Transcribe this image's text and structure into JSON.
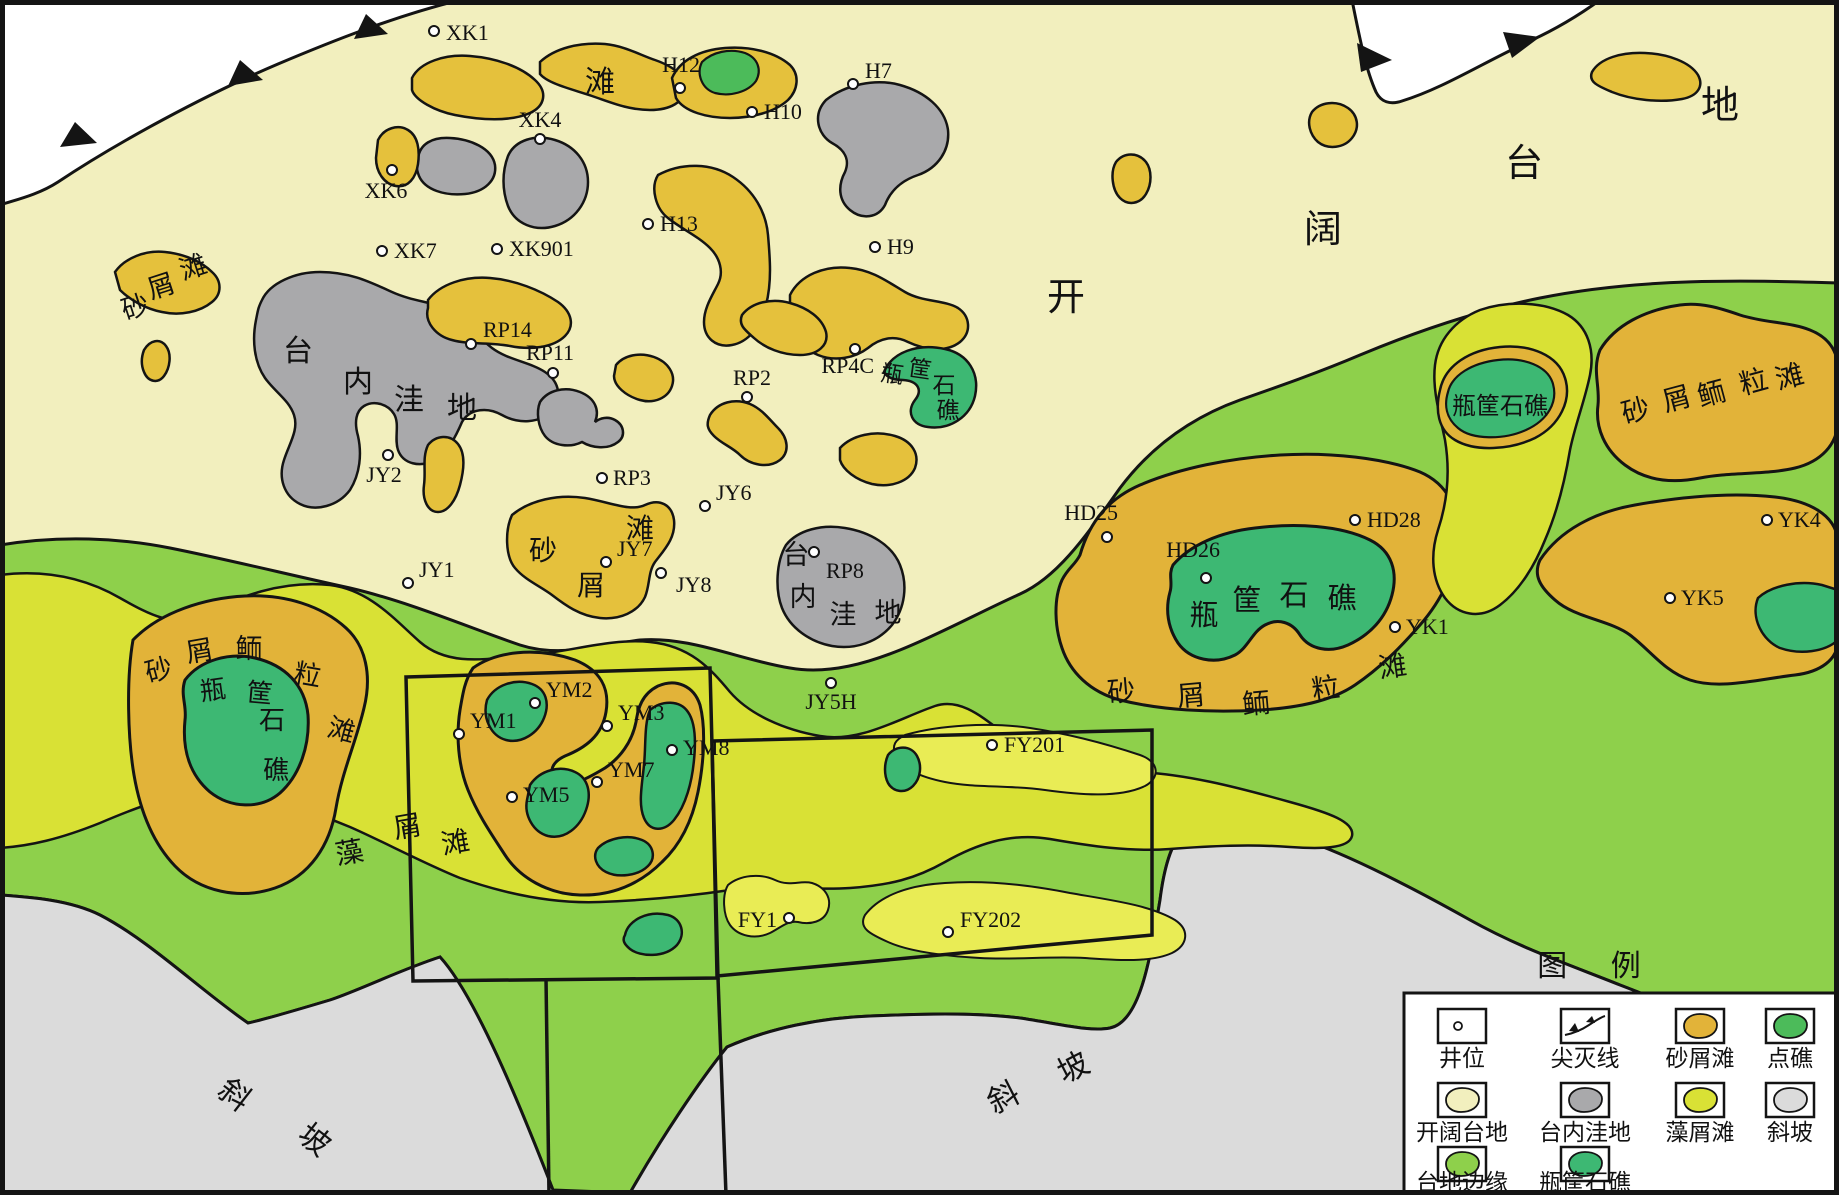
{
  "map_type": "carbonate platform sedimentary facies map",
  "colors": {
    "open_platform": "#f2efbe",
    "platform_margin": "#8ed04b",
    "algal_shoal": "#d9e135",
    "algal_shoal_light": "#e9ec55",
    "sand_shoal": "#e5c13c",
    "ooid_shoal": "#e2b339",
    "reef": "#3db873",
    "patch_reef": "#4cbb5a",
    "depression": "#a9a9ab",
    "slope": "#dbdbdb",
    "outside": "#ffffff",
    "line": "#141414"
  },
  "wells": [
    {
      "id": "XK1",
      "cx": 434,
      "cy": 31,
      "lx": 446,
      "ly": 40,
      "anchor": "start"
    },
    {
      "id": "XK6",
      "cx": 392,
      "cy": 170,
      "lx": 386,
      "ly": 198,
      "anchor": "middle"
    },
    {
      "id": "XK4",
      "cx": 540,
      "cy": 139,
      "lx": 540,
      "ly": 127,
      "anchor": "middle"
    },
    {
      "id": "XK7",
      "cx": 382,
      "cy": 251,
      "lx": 394,
      "ly": 258,
      "anchor": "start"
    },
    {
      "id": "XK901",
      "cx": 497,
      "cy": 249,
      "lx": 509,
      "ly": 256,
      "anchor": "start"
    },
    {
      "id": "H12",
      "cx": 680,
      "cy": 88,
      "lx": 700,
      "ly": 72,
      "anchor": "end"
    },
    {
      "id": "H10",
      "cx": 752,
      "cy": 112,
      "lx": 764,
      "ly": 119,
      "anchor": "start"
    },
    {
      "id": "H7",
      "cx": 853,
      "cy": 84,
      "lx": 865,
      "ly": 78,
      "anchor": "start"
    },
    {
      "id": "H13",
      "cx": 648,
      "cy": 224,
      "lx": 660,
      "ly": 231,
      "anchor": "start"
    },
    {
      "id": "H9",
      "cx": 875,
      "cy": 247,
      "lx": 887,
      "ly": 254,
      "anchor": "start"
    },
    {
      "id": "RP14",
      "cx": 471,
      "cy": 344,
      "lx": 483,
      "ly": 337,
      "anchor": "start"
    },
    {
      "id": "RP11",
      "cx": 553,
      "cy": 373,
      "lx": 550,
      "ly": 360,
      "anchor": "middle"
    },
    {
      "id": "RP2",
      "cx": 747,
      "cy": 397,
      "lx": 752,
      "ly": 385,
      "anchor": "middle"
    },
    {
      "id": "RP4C",
      "cx": 855,
      "cy": 349,
      "lx": 874,
      "ly": 373,
      "anchor": "end"
    },
    {
      "id": "RP3",
      "cx": 602,
      "cy": 478,
      "lx": 613,
      "ly": 485,
      "anchor": "start"
    },
    {
      "id": "JY6",
      "cx": 705,
      "cy": 506,
      "lx": 716,
      "ly": 500,
      "anchor": "start"
    },
    {
      "id": "JY7",
      "cx": 606,
      "cy": 562,
      "lx": 617,
      "ly": 556,
      "anchor": "start"
    },
    {
      "id": "JY8",
      "cx": 661,
      "cy": 573,
      "lx": 676,
      "ly": 592,
      "anchor": "start"
    },
    {
      "id": "JY2",
      "cx": 388,
      "cy": 455,
      "lx": 384,
      "ly": 482,
      "anchor": "middle"
    },
    {
      "id": "JY1",
      "cx": 408,
      "cy": 583,
      "lx": 419,
      "ly": 577,
      "anchor": "start"
    },
    {
      "id": "RP8",
      "cx": 814,
      "cy": 552,
      "lx": 826,
      "ly": 578,
      "anchor": "start"
    },
    {
      "id": "JY5H",
      "cx": 831,
      "cy": 683,
      "lx": 831,
      "ly": 709,
      "anchor": "middle"
    },
    {
      "id": "YM1",
      "cx": 459,
      "cy": 734,
      "lx": 470,
      "ly": 728,
      "anchor": "start"
    },
    {
      "id": "YM2",
      "cx": 535,
      "cy": 703,
      "lx": 546,
      "ly": 697,
      "anchor": "start"
    },
    {
      "id": "YM3",
      "cx": 607,
      "cy": 726,
      "lx": 618,
      "ly": 720,
      "anchor": "start"
    },
    {
      "id": "YM5",
      "cx": 512,
      "cy": 797,
      "lx": 523,
      "ly": 802,
      "anchor": "start"
    },
    {
      "id": "YM7",
      "cx": 597,
      "cy": 782,
      "lx": 608,
      "ly": 777,
      "anchor": "start"
    },
    {
      "id": "YM8",
      "cx": 672,
      "cy": 750,
      "lx": 683,
      "ly": 755,
      "anchor": "start"
    },
    {
      "id": "FY201",
      "cx": 992,
      "cy": 745,
      "lx": 1004,
      "ly": 752,
      "anchor": "start"
    },
    {
      "id": "FY1",
      "cx": 789,
      "cy": 918,
      "lx": 777,
      "ly": 927,
      "anchor": "end"
    },
    {
      "id": "FY202",
      "cx": 948,
      "cy": 932,
      "lx": 960,
      "ly": 927,
      "anchor": "start"
    },
    {
      "id": "HD25",
      "cx": 1107,
      "cy": 537,
      "lx": 1118,
      "ly": 520,
      "anchor": "end"
    },
    {
      "id": "HD26",
      "cx": 1206,
      "cy": 578,
      "lx": 1220,
      "ly": 557,
      "anchor": "end"
    },
    {
      "id": "HD28",
      "cx": 1355,
      "cy": 520,
      "lx": 1367,
      "ly": 527,
      "anchor": "start"
    },
    {
      "id": "YK1",
      "cx": 1395,
      "cy": 627,
      "lx": 1406,
      "ly": 634,
      "anchor": "start"
    },
    {
      "id": "YK4",
      "cx": 1767,
      "cy": 520,
      "lx": 1778,
      "ly": 527,
      "anchor": "start"
    },
    {
      "id": "YK5",
      "cx": 1670,
      "cy": 598,
      "lx": 1681,
      "ly": 605,
      "anchor": "start"
    }
  ],
  "region_labels": [
    {
      "t": "开",
      "x": 1066,
      "y": 310,
      "s": 38,
      "r": 0
    },
    {
      "t": "阔",
      "x": 1323,
      "y": 242,
      "s": 38,
      "r": 0
    },
    {
      "t": "台",
      "x": 1524,
      "y": 176,
      "s": 38,
      "r": 0
    },
    {
      "t": "地",
      "x": 1720,
      "y": 118,
      "s": 38,
      "r": 0
    },
    {
      "t": "滩",
      "x": 600,
      "y": 92,
      "s": 30,
      "r": 0
    },
    {
      "t": "砂",
      "x": 138,
      "y": 316,
      "s": 27,
      "r": -18
    },
    {
      "t": "屑",
      "x": 164,
      "y": 295,
      "s": 27,
      "r": -18
    },
    {
      "t": "滩",
      "x": 196,
      "y": 276,
      "s": 27,
      "r": -18
    },
    {
      "t": "台",
      "x": 298,
      "y": 361,
      "s": 30,
      "r": 0
    },
    {
      "t": "内",
      "x": 358,
      "y": 392,
      "s": 30,
      "r": 0
    },
    {
      "t": "洼",
      "x": 409,
      "y": 410,
      "s": 30,
      "r": 0
    },
    {
      "t": "地",
      "x": 462,
      "y": 418,
      "s": 30,
      "r": 0
    },
    {
      "t": "砂",
      "x": 543,
      "y": 560,
      "s": 28,
      "r": 0
    },
    {
      "t": "屑",
      "x": 591,
      "y": 595,
      "s": 28,
      "r": 0
    },
    {
      "t": "滩",
      "x": 640,
      "y": 538,
      "s": 28,
      "r": 0
    },
    {
      "t": "台",
      "x": 796,
      "y": 564,
      "s": 27,
      "r": 0
    },
    {
      "t": "内",
      "x": 803,
      "y": 606,
      "s": 27,
      "r": 0
    },
    {
      "t": "洼",
      "x": 843,
      "y": 624,
      "s": 27,
      "r": 0
    },
    {
      "t": "地",
      "x": 888,
      "y": 622,
      "s": 27,
      "r": 0
    },
    {
      "t": "瓶",
      "x": 891,
      "y": 382,
      "s": 23,
      "r": 8
    },
    {
      "t": "筐",
      "x": 919,
      "y": 377,
      "s": 23,
      "r": 8
    },
    {
      "t": "石",
      "x": 944,
      "y": 393,
      "s": 23,
      "r": 0
    },
    {
      "t": "礁",
      "x": 948,
      "y": 418,
      "s": 23,
      "r": 0
    },
    {
      "t": "砂",
      "x": 161,
      "y": 679,
      "s": 27,
      "r": -15
    },
    {
      "t": "屑",
      "x": 201,
      "y": 660,
      "s": 27,
      "r": -10
    },
    {
      "t": "鲕",
      "x": 249,
      "y": 658,
      "s": 27,
      "r": 0
    },
    {
      "t": "粒",
      "x": 306,
      "y": 684,
      "s": 27,
      "r": 10
    },
    {
      "t": "滩",
      "x": 339,
      "y": 739,
      "s": 27,
      "r": 15
    },
    {
      "t": "瓶",
      "x": 214,
      "y": 699,
      "s": 26,
      "r": -8
    },
    {
      "t": "筐",
      "x": 259,
      "y": 702,
      "s": 26,
      "r": 5
    },
    {
      "t": "石",
      "x": 272,
      "y": 729,
      "s": 26,
      "r": 0
    },
    {
      "t": "礁",
      "x": 276,
      "y": 779,
      "s": 26,
      "r": 0
    },
    {
      "t": "藻",
      "x": 351,
      "y": 862,
      "s": 28,
      "r": -10
    },
    {
      "t": "屑",
      "x": 409,
      "y": 836,
      "s": 28,
      "r": -10
    },
    {
      "t": "滩",
      "x": 457,
      "y": 852,
      "s": 28,
      "r": -10
    },
    {
      "t": "瓶",
      "x": 1204,
      "y": 625,
      "s": 29,
      "r": 0
    },
    {
      "t": "筐",
      "x": 1247,
      "y": 610,
      "s": 29,
      "r": 0
    },
    {
      "t": "石",
      "x": 1294,
      "y": 605,
      "s": 29,
      "r": 0
    },
    {
      "t": "礁",
      "x": 1342,
      "y": 608,
      "s": 29,
      "r": 0
    },
    {
      "t": "砂",
      "x": 1122,
      "y": 701,
      "s": 28,
      "r": -5
    },
    {
      "t": "屑",
      "x": 1192,
      "y": 705,
      "s": 28,
      "r": -5
    },
    {
      "t": "鲕",
      "x": 1257,
      "y": 713,
      "s": 28,
      "r": -5
    },
    {
      "t": "粒",
      "x": 1327,
      "y": 698,
      "s": 28,
      "r": -8
    },
    {
      "t": "滩",
      "x": 1394,
      "y": 676,
      "s": 28,
      "r": -8
    },
    {
      "t": "瓶筐石礁",
      "x": 1500,
      "y": 414,
      "s": 24,
      "r": 0
    },
    {
      "t": "砂",
      "x": 1638,
      "y": 420,
      "s": 28,
      "r": -15
    },
    {
      "t": "屑",
      "x": 1679,
      "y": 408,
      "s": 28,
      "r": -15
    },
    {
      "t": "鲕",
      "x": 1714,
      "y": 403,
      "s": 28,
      "r": -15
    },
    {
      "t": "粒",
      "x": 1756,
      "y": 391,
      "s": 28,
      "r": -15
    },
    {
      "t": "滩",
      "x": 1792,
      "y": 386,
      "s": 28,
      "r": -15
    },
    {
      "t": "斜",
      "x": 228,
      "y": 1103,
      "s": 31,
      "r": 38
    },
    {
      "t": "坡",
      "x": 308,
      "y": 1148,
      "s": 31,
      "r": 38
    },
    {
      "t": "斜",
      "x": 1008,
      "y": 1107,
      "s": 31,
      "r": -27
    },
    {
      "t": "坡",
      "x": 1078,
      "y": 1077,
      "s": 31,
      "r": -27
    }
  ],
  "survey_boxes": {
    "box1": "406,677 710,668 718,978 413,981",
    "box2": "712,741 1152,730 1152,935 717,976",
    "line_a": "546,978 549,1195",
    "line_b": "718,978 726,1195"
  },
  "legend": {
    "title": "图 例",
    "title_x": 1598,
    "title_y": 976,
    "box": {
      "x": 1404,
      "y": 993,
      "w": 432,
      "h": 200
    },
    "cols_x": [
      1462,
      1585,
      1700,
      1790
    ],
    "rows": [
      {
        "swatch_cy": 1026,
        "label_y": 1066,
        "items": [
          {
            "label": "井位",
            "type": "well"
          },
          {
            "label": "尖灭线",
            "type": "pinchout"
          },
          {
            "label": "砂屑滩",
            "type": "blob",
            "color_key": "ooid_shoal"
          },
          {
            "label": "点礁",
            "type": "blob",
            "color_key": "patch_reef"
          }
        ]
      },
      {
        "swatch_cy": 1100,
        "label_y": 1140,
        "items": [
          {
            "label": "开阔台地",
            "type": "blob",
            "color_key": "open_platform"
          },
          {
            "label": "台内洼地",
            "type": "blob",
            "color_key": "depression"
          },
          {
            "label": "藻屑滩",
            "type": "blob",
            "color_key": "algal_shoal"
          },
          {
            "label": "斜坡",
            "type": "blob",
            "color_key": "slope"
          }
        ]
      },
      {
        "swatch_cy": 1164,
        "label_y": 1190,
        "items": [
          {
            "label": "台地边缘",
            "type": "blob",
            "color_key": "platform_margin"
          },
          {
            "label": "瓶筐石礁",
            "type": "blob",
            "color_key": "reef"
          }
        ]
      }
    ]
  }
}
